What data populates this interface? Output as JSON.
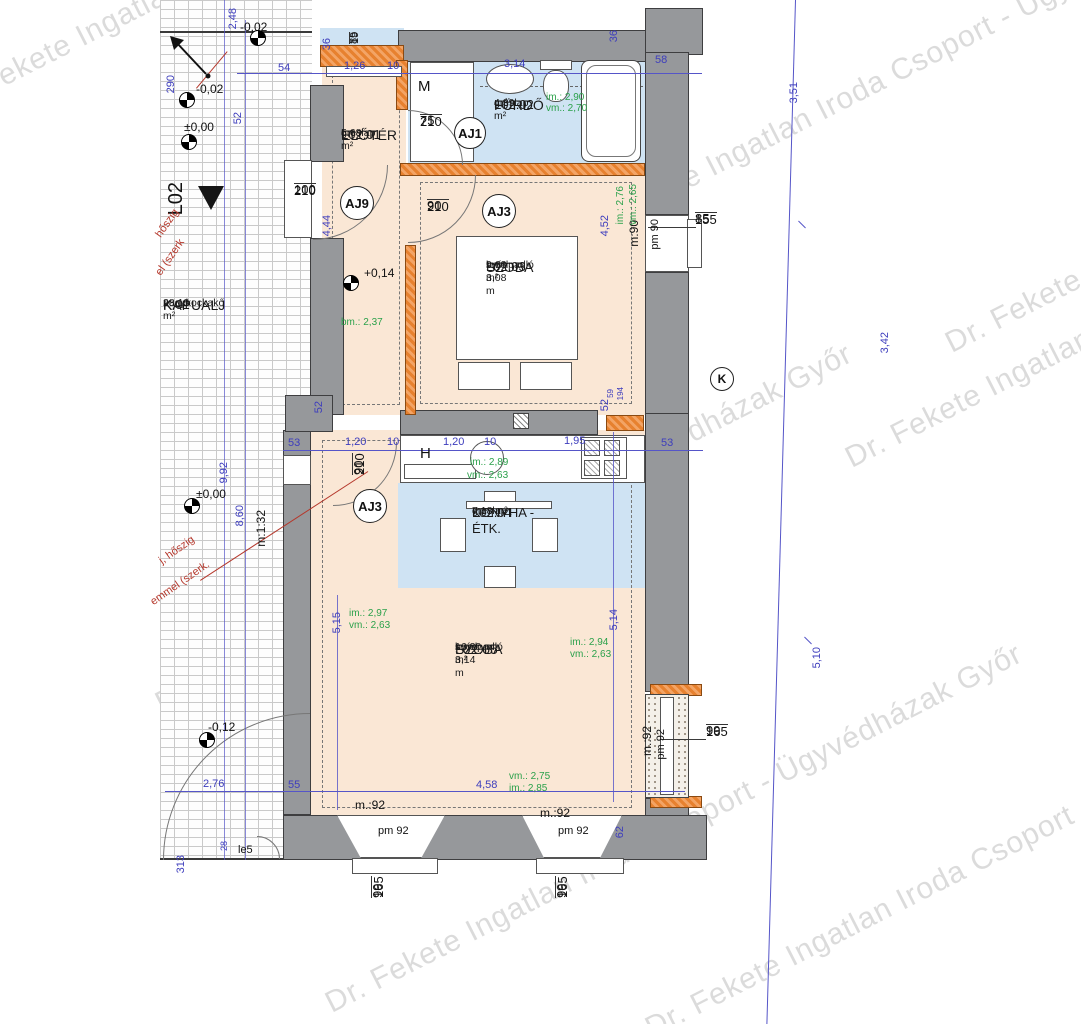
{
  "watermark": {
    "text": "Dr. Fekete Ingatlan Iroda Csoport - Ügyvédházak Győr",
    "color": "#7d7d7d",
    "instances": [
      {
        "x": -70,
        "y": 95
      },
      {
        "x": 560,
        "y": 225
      },
      {
        "x": 940,
        "y": 330
      },
      {
        "x": 150,
        "y": 690
      },
      {
        "x": 840,
        "y": 445
      },
      {
        "x": 320,
        "y": 990
      },
      {
        "x": 640,
        "y": 1015
      }
    ]
  },
  "colors": {
    "wall": "#96989b",
    "new_wall_orange": "#e7812f",
    "floor_peach": "#fae7d5",
    "floor_blue": "#cfe3f3",
    "dim_blue": "#3d3dbd",
    "height_green": "#2ba14b",
    "note_red": "#b5382c"
  },
  "rooms": [
    {
      "code": "L02.01",
      "name": "ELŐTÉR",
      "flooring": "greslap",
      "area": "5,68 m²",
      "bm": ""
    },
    {
      "code": "L02.02",
      "name": "FÜRDŐ",
      "flooring": "greslap",
      "area": "4,39 m²",
      "bm": ""
    },
    {
      "code": "L02.03",
      "name": "SZOBA",
      "flooring": "svédpadló",
      "area": "9,63 m²",
      "bm": "bm= 3,08 m"
    },
    {
      "code": "L02.04",
      "name": "KONYHA - ÉTK.",
      "flooring": "greslap",
      "area": "7,18 m²",
      "bm": ""
    },
    {
      "code": "L02.05",
      "name": "SZOBA",
      "flooring": "svédpadló",
      "area": "16,30 m²",
      "bm": "bm= 3,14 m"
    },
    {
      "code": "K.01",
      "name": "KAPUALJ",
      "flooring": "nagykockakő",
      "area": "28,13 m²",
      "bm": ""
    }
  ],
  "circles": [
    {
      "label": "AJ1",
      "x": 470,
      "y": 133,
      "r": 16
    },
    {
      "label": "AJ9",
      "x": 357,
      "y": 203,
      "r": 17
    },
    {
      "label": "AJ3",
      "x": 499,
      "y": 211,
      "r": 17
    },
    {
      "label": "AJ3",
      "x": 370,
      "y": 506,
      "r": 17
    },
    {
      "label": "K",
      "x": 722,
      "y": 379,
      "r": 12
    }
  ],
  "levels": [
    {
      "x": 258,
      "y": 38
    },
    {
      "x": 187,
      "y": 100
    },
    {
      "x": 189,
      "y": 142
    },
    {
      "x": 351,
      "y": 283
    },
    {
      "x": 192,
      "y": 506
    },
    {
      "x": 207,
      "y": 740
    }
  ],
  "annotations": [
    {
      "n": "dim-248",
      "t": "2,48",
      "x": 228,
      "y": 8,
      "c": "dim vtx"
    },
    {
      "n": "dim-290",
      "t": "290",
      "x": 166,
      "y": 75,
      "c": "dim vtx"
    },
    {
      "n": "dim-52-top",
      "t": "52",
      "x": 233,
      "y": 112,
      "c": "dim vtx"
    },
    {
      "n": "dim-54",
      "t": "54",
      "x": 278,
      "y": 63,
      "c": "dim"
    },
    {
      "n": "dim-126",
      "t": "1,26",
      "x": 344,
      "y": 61,
      "c": "dim"
    },
    {
      "n": "dim-10-top",
      "t": "10",
      "x": 387,
      "y": 61,
      "c": "dim"
    },
    {
      "n": "dim-314",
      "t": "3,14",
      "x": 504,
      "y": 59,
      "c": "dim"
    },
    {
      "n": "dim-58",
      "t": "58",
      "x": 655,
      "y": 55,
      "c": "dim"
    },
    {
      "n": "dim-36-right",
      "t": "36",
      "x": 609,
      "y": 30,
      "c": "dim vtx"
    },
    {
      "n": "dim-36-left",
      "t": "36",
      "x": 322,
      "y": 38,
      "c": "dim vtx"
    },
    {
      "n": "dim-85-19",
      "t": "85/19",
      "x": 349,
      "y": 44,
      "c": "frac fracv",
      "s": 11
    },
    {
      "n": "dim-444",
      "t": "4,44",
      "x": 322,
      "y": 215,
      "c": "dim vtx"
    },
    {
      "n": "dim-452",
      "t": "4,52",
      "x": 600,
      "y": 215,
      "c": "dim vtx"
    },
    {
      "n": "door-75-210",
      "t": "75/210",
      "x": 420,
      "y": 114,
      "c": "frac"
    },
    {
      "n": "door-100-210",
      "t": "100/210",
      "x": 294,
      "y": 183,
      "c": "frac"
    },
    {
      "n": "door-90-210",
      "t": "90/210",
      "x": 427,
      "y": 199,
      "c": "frac"
    },
    {
      "n": "win-85-155",
      "t": "85/155",
      "x": 695,
      "y": 212,
      "c": "frac"
    },
    {
      "n": "lbl-m90",
      "t": "m:90",
      "x": 628,
      "y": 220,
      "c": "vtx",
      "s": 12
    },
    {
      "n": "lbl-pm90",
      "t": "pm 90",
      "x": 650,
      "y": 219,
      "c": "vtx",
      "s": 11
    },
    {
      "n": "grn-im276",
      "t": "im.: 2,76",
      "x": 616,
      "y": 186,
      "c": "grn vtx",
      "s": 10
    },
    {
      "n": "grn-vm265",
      "t": "vm.: 2,65",
      "x": 629,
      "y": 184,
      "c": "grn vtx",
      "s": 10
    },
    {
      "n": "grn-im290",
      "t": "im.: 2,90",
      "x": 546,
      "y": 93,
      "c": "grn",
      "s": 10
    },
    {
      "n": "grn-vm270",
      "t": "vm.: 2,70",
      "x": 546,
      "y": 104,
      "c": "grn",
      "s": 10
    },
    {
      "n": "lbl-m",
      "t": "M",
      "x": 418,
      "y": 79,
      "c": "",
      "s": 15
    },
    {
      "n": "lvl-p014",
      "t": "+0,14",
      "x": 364,
      "y": 267,
      "c": "",
      "s": 12
    },
    {
      "n": "grn-bm237",
      "t": "bm.: 2,37",
      "x": 341,
      "y": 318,
      "c": "grn",
      "s": 10
    },
    {
      "n": "lvl-002a",
      "t": "-0,02",
      "x": 240,
      "y": 21,
      "c": "",
      "s": 12
    },
    {
      "n": "lvl-002b",
      "t": "-0,02",
      "x": 196,
      "y": 83,
      "c": "",
      "s": 12
    },
    {
      "n": "lvl-000a",
      "t": "±0,00",
      "x": 184,
      "y": 121,
      "c": "",
      "s": 12
    },
    {
      "n": "lvl-000b",
      "t": "±0,00",
      "x": 196,
      "y": 488,
      "c": "",
      "s": 12
    },
    {
      "n": "lvl-012",
      "t": "-0,12",
      "x": 208,
      "y": 721,
      "c": "",
      "s": 12
    },
    {
      "n": "lbl-l02",
      "t": "L02",
      "x": 166,
      "y": 182,
      "c": "vtx",
      "s": 20
    },
    {
      "n": "red-hoszig-a",
      "t": "hőszig",
      "x": 152,
      "y": 218,
      "c": "red",
      "r": -55,
      "s": 11
    },
    {
      "n": "red-szerk-a",
      "t": "el (szerk",
      "x": 150,
      "y": 252,
      "c": "red",
      "r": -55,
      "s": 11
    },
    {
      "n": "red-hoszig-b",
      "t": "j, hőszig",
      "x": 157,
      "y": 545,
      "c": "red",
      "r": -35,
      "s": 11
    },
    {
      "n": "red-szerk-b",
      "t": "emmel (szerk.",
      "x": 146,
      "y": 578,
      "c": "red",
      "r": -35,
      "s": 11
    },
    {
      "n": "dim-53-l",
      "t": "53",
      "x": 288,
      "y": 438,
      "c": "dim"
    },
    {
      "n": "dim-120a",
      "t": "1,20",
      "x": 345,
      "y": 437,
      "c": "dim"
    },
    {
      "n": "dim-10a",
      "t": "10",
      "x": 387,
      "y": 437,
      "c": "dim"
    },
    {
      "n": "dim-120b",
      "t": "1,20",
      "x": 443,
      "y": 437,
      "c": "dim"
    },
    {
      "n": "dim-10b",
      "t": "10",
      "x": 484,
      "y": 437,
      "c": "dim"
    },
    {
      "n": "dim-195",
      "t": "1,95",
      "x": 564,
      "y": 436,
      "c": "dim"
    },
    {
      "n": "dim-53-r",
      "t": "53",
      "x": 661,
      "y": 438,
      "c": "dim"
    },
    {
      "n": "dim-52-ml",
      "t": "52",
      "x": 314,
      "y": 401,
      "c": "dim vtx"
    },
    {
      "n": "dim-52-mr",
      "t": "52",
      "x": 600,
      "y": 399,
      "c": "dim vtx"
    },
    {
      "n": "dim-59",
      "t": "59",
      "x": 607,
      "y": 389,
      "c": "dim vtx",
      "s": 8
    },
    {
      "n": "dim-194",
      "t": "194",
      "x": 617,
      "y": 387,
      "c": "dim vtx",
      "s": 8
    },
    {
      "n": "door-90-210-v",
      "t": "90/210",
      "x": 352,
      "y": 475,
      "c": "frac fracv"
    },
    {
      "n": "lbl-h",
      "t": "H",
      "x": 420,
      "y": 446,
      "c": "",
      "s": 15
    },
    {
      "n": "grn-im289",
      "t": "im.: 2,89",
      "x": 470,
      "y": 458,
      "c": "grn",
      "s": 10
    },
    {
      "n": "grn-vm263a",
      "t": "vm.: 2,63",
      "x": 467,
      "y": 471,
      "c": "grn",
      "s": 10
    },
    {
      "n": "dim-515",
      "t": "5,15",
      "x": 332,
      "y": 612,
      "c": "dim vtx"
    },
    {
      "n": "dim-514",
      "t": "5,14",
      "x": 609,
      "y": 609,
      "c": "dim vtx"
    },
    {
      "n": "grn-im297",
      "t": "im.: 2,97",
      "x": 349,
      "y": 609,
      "c": "grn",
      "s": 10
    },
    {
      "n": "grn-vm263b",
      "t": "vm.: 2,63",
      "x": 349,
      "y": 621,
      "c": "grn",
      "s": 10
    },
    {
      "n": "grn-im294",
      "t": "im.: 2,94",
      "x": 570,
      "y": 638,
      "c": "grn",
      "s": 10
    },
    {
      "n": "grn-vm263c",
      "t": "vm.: 2,63",
      "x": 570,
      "y": 650,
      "c": "grn",
      "s": 10
    },
    {
      "n": "lbl-m132",
      "t": "m:1:32",
      "x": 255,
      "y": 510,
      "c": "vtx",
      "s": 12
    },
    {
      "n": "dim-992",
      "t": "9,92",
      "x": 219,
      "y": 462,
      "c": "dim vtx"
    },
    {
      "n": "dim-860",
      "t": "8,60",
      "x": 235,
      "y": 505,
      "c": "dim vtx"
    },
    {
      "n": "win-m92-v",
      "t": "m.:92",
      "x": 641,
      "y": 726,
      "c": "vtx",
      "s": 12
    },
    {
      "n": "win-pm92-v",
      "t": "pm 92",
      "x": 656,
      "y": 729,
      "c": "vtx",
      "s": 11
    },
    {
      "n": "win-99-165-r",
      "t": "99/165",
      "x": 706,
      "y": 724,
      "c": "frac"
    },
    {
      "n": "dim-276",
      "t": "2,76",
      "x": 203,
      "y": 779,
      "c": "dim"
    },
    {
      "n": "dim-55",
      "t": "55",
      "x": 288,
      "y": 780,
      "c": "dim"
    },
    {
      "n": "dim-458",
      "t": "4,58",
      "x": 476,
      "y": 780,
      "c": "dim"
    },
    {
      "n": "grn-vm275",
      "t": "vm.: 2,75",
      "x": 509,
      "y": 772,
      "c": "grn",
      "s": 10
    },
    {
      "n": "grn-im285",
      "t": "im.: 2,85",
      "x": 509,
      "y": 784,
      "c": "grn",
      "s": 10
    },
    {
      "n": "win-m92-a",
      "t": "m.:92",
      "x": 355,
      "y": 799,
      "c": "",
      "s": 12
    },
    {
      "n": "win-pm92-a",
      "t": "pm 92",
      "x": 378,
      "y": 826,
      "c": "",
      "s": 11
    },
    {
      "n": "win-m92-b",
      "t": "m.:92",
      "x": 540,
      "y": 807,
      "c": "",
      "s": 12
    },
    {
      "n": "win-pm92-b",
      "t": "pm 92",
      "x": 558,
      "y": 826,
      "c": "",
      "s": 11
    },
    {
      "n": "dim-62",
      "t": "62",
      "x": 615,
      "y": 826,
      "c": "dim vtx"
    },
    {
      "n": "dim-28",
      "t": "28",
      "x": 220,
      "y": 841,
      "c": "dim vtx",
      "s": 9
    },
    {
      "n": "lbl-le5",
      "t": "le5",
      "x": 238,
      "y": 845,
      "c": "",
      "s": 11
    },
    {
      "n": "dim-313",
      "t": "313",
      "x": 176,
      "y": 855,
      "c": "dim vtx"
    },
    {
      "n": "win-99-165-a",
      "t": "99/165",
      "x": 371,
      "y": 898,
      "c": "frac fracv"
    },
    {
      "n": "win-99-165-b",
      "t": "99/165",
      "x": 555,
      "y": 898,
      "c": "frac fracv"
    },
    {
      "n": "dim-351",
      "t": "3,51",
      "x": 789,
      "y": 82,
      "c": "dim vtx"
    },
    {
      "n": "dim-342",
      "t": "3,42",
      "x": 880,
      "y": 332,
      "c": "dim vtx"
    },
    {
      "n": "dim-510",
      "t": "5,10",
      "x": 812,
      "y": 647,
      "c": "dim vtx"
    }
  ]
}
